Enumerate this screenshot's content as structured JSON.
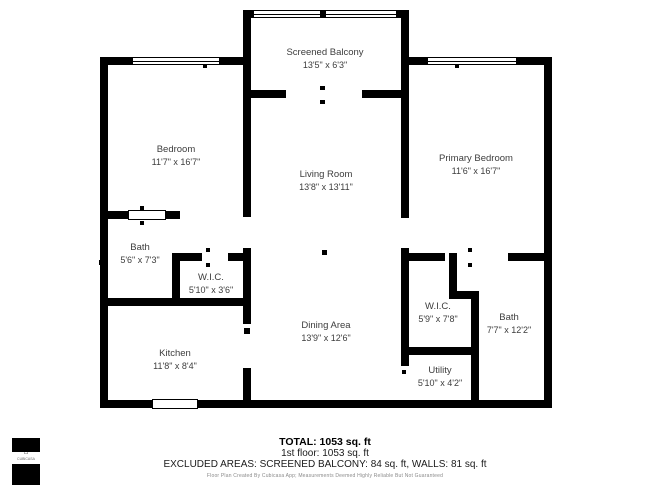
{
  "plan": {
    "rooms": {
      "screened_balcony": {
        "name": "Screened Balcony",
        "dims": "13'5\" x 6'3\""
      },
      "bedroom": {
        "name": "Bedroom",
        "dims": "11'7\" x 16'7\""
      },
      "living_room": {
        "name": "Living Room",
        "dims": "13'8\" x 13'11\""
      },
      "primary_bedroom": {
        "name": "Primary Bedroom",
        "dims": "11'6\" x 16'7\""
      },
      "bath_left": {
        "name": "Bath",
        "dims": "5'6\" x 7'3\""
      },
      "wic_left": {
        "name": "W.I.C.",
        "dims": "5'10\" x 3'6\""
      },
      "kitchen": {
        "name": "Kitchen",
        "dims": "11'8\" x 8'4\""
      },
      "dining_area": {
        "name": "Dining Area",
        "dims": "13'9\" x 12'6\""
      },
      "wic_right": {
        "name": "W.I.C.",
        "dims": "5'9\" x 7'8\""
      },
      "bath_right": {
        "name": "Bath",
        "dims": "7'7\" x 12'2\""
      },
      "utility": {
        "name": "Utility",
        "dims": "5'10\" x 4'2\""
      }
    }
  },
  "summary": {
    "total": "TOTAL: 1053 sq. ft",
    "floor": "1st floor: 1053 sq. ft",
    "excluded": "EXCLUDED AREAS: SCREENED BALCONY: 84 sq. ft, WALLS: 81 sq. ft",
    "disclaimer": "Floor Plan Created By Cubicasa App; Measurements Deemed Highly Reliable But Not Guaranteed"
  },
  "logo": {
    "text": "CUBICASA",
    "house_glyph": "⌂"
  },
  "colors": {
    "wall": "#000000",
    "label": "#3d3d3d",
    "disclaimer": "#8a8a8a"
  }
}
